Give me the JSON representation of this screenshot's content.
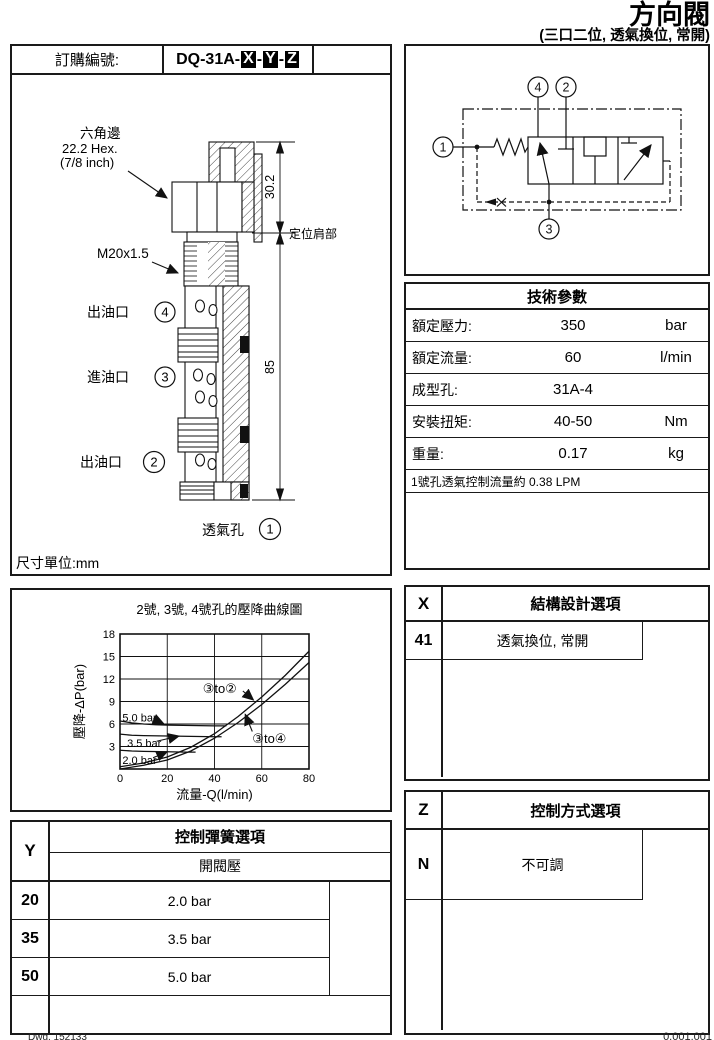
{
  "page": {
    "title": "方向閥",
    "subtitle": "(三口二位, 透氣換位, 常開)",
    "footer_left": "Dwg. 152133",
    "footer_right": "0.001.001"
  },
  "order": {
    "label": "訂購編號:",
    "prefix": "DQ-31A-",
    "dash": "-",
    "x": "X",
    "y": "Y",
    "z": "Z"
  },
  "drawing": {
    "unit_note": "尺寸單位:mm",
    "hex_label_1": "六角邊",
    "hex_label_2": "22.2 Hex.",
    "hex_label_3": "(7/8 inch)",
    "thread_label": "M20x1.5",
    "shoulder_label": "定位肩部",
    "dim_top": "30.2",
    "dim_body": "85",
    "port4_label": "出油口",
    "port3_label": "進油口",
    "port2_label": "出油口",
    "port1_label": "透氣孔",
    "port_numbers": {
      "p1": "1",
      "p2": "2",
      "p3": "3",
      "p4": "4"
    }
  },
  "schematic": {
    "p1": "1",
    "p2": "2",
    "p3": "3",
    "p4": "4"
  },
  "tech_table": {
    "title": "技術參數",
    "rows": [
      {
        "label": "額定壓力:",
        "value": "350",
        "unit": "bar"
      },
      {
        "label": "額定流量:",
        "value": "60",
        "unit": "l/min"
      },
      {
        "label": "成型孔:",
        "value": "31A-4",
        "unit": ""
      },
      {
        "label": "安裝扭矩:",
        "value": "40-50",
        "unit": "Nm"
      },
      {
        "label": "重量:",
        "value": "0.17",
        "unit": "kg"
      }
    ],
    "note": "1號孔透氣控制流量約 0.38 LPM"
  },
  "x_table": {
    "code": "X",
    "title": "結構設計選項",
    "rows": [
      {
        "code": "41",
        "desc": "透氣換位, 常開"
      }
    ]
  },
  "y_table": {
    "code": "Y",
    "title": "控制彈簧選項",
    "subtitle": "開閥壓",
    "rows": [
      {
        "code": "20",
        "desc": "2.0 bar"
      },
      {
        "code": "35",
        "desc": "3.5 bar"
      },
      {
        "code": "50",
        "desc": "5.0 bar"
      }
    ]
  },
  "z_table": {
    "code": "Z",
    "title": "控制方式選項",
    "rows": [
      {
        "code": "N",
        "desc": "不可調"
      }
    ]
  },
  "chart_data": {
    "type": "line",
    "title": "2號, 3號, 4號孔的壓降曲線圖",
    "xlabel": "流量-Q(l/min)",
    "ylabel": "壓降-ΔP(bar)",
    "xlim": [
      0,
      80
    ],
    "ylim": [
      0,
      18
    ],
    "xticks": [
      0,
      20,
      40,
      60,
      80
    ],
    "yticks": [
      3,
      6,
      9,
      12,
      15,
      18
    ],
    "grid": true,
    "legend_position": "none",
    "series": [
      {
        "name": "③to②",
        "x": [
          0,
          10,
          20,
          30,
          40,
          50,
          55,
          60,
          70,
          80
        ],
        "y": [
          0.3,
          0.8,
          1.6,
          2.9,
          4.7,
          7.0,
          8.3,
          9.6,
          12.5,
          15.7
        ]
      },
      {
        "name": "③to④",
        "x": [
          0,
          10,
          20,
          30,
          40,
          50,
          60,
          70,
          80
        ],
        "y": [
          0.0,
          0.5,
          1.2,
          2.4,
          4.1,
          6.2,
          8.6,
          11.3,
          14.2
        ]
      },
      {
        "name": "5.0 bar",
        "x": [
          0,
          5,
          10,
          15,
          20,
          30,
          40,
          45
        ],
        "y": [
          6.4,
          6.15,
          6.0,
          5.9,
          5.85,
          5.8,
          5.75,
          5.75
        ]
      },
      {
        "name": "3.5 bar",
        "x": [
          0,
          5,
          10,
          20,
          30,
          40,
          43
        ],
        "y": [
          4.65,
          4.5,
          4.45,
          4.4,
          4.35,
          4.3,
          4.3
        ]
      },
      {
        "name": "2.0 bar",
        "x": [
          0,
          5,
          10,
          20,
          28,
          32
        ],
        "y": [
          2.5,
          2.4,
          2.35,
          2.3,
          2.25,
          2.25
        ]
      }
    ],
    "annotations": [
      {
        "text": "5.0 bar",
        "tx": 1,
        "ty": 6.9,
        "sx": 14,
        "sy": 6.7,
        "ax": 18.5,
        "ay": 6.05,
        "fs": 11
      },
      {
        "text": "3.5 bar",
        "tx": 3,
        "ty": 3.5,
        "sx": 15.5,
        "sy": 3.7,
        "ax": 25,
        "ay": 4.4,
        "fs": 11
      },
      {
        "text": "2.0 bar",
        "tx": 1,
        "ty": 1.2,
        "sx": 14,
        "sy": 1.5,
        "ax": 20,
        "ay": 2.3,
        "fs": 11
      },
      {
        "text": "③to②",
        "tx": 35,
        "ty": 10.7,
        "sx": 52,
        "sy": 10.4,
        "ax": 56.5,
        "ay": 9.2,
        "fs": 13
      },
      {
        "text": "③to④",
        "tx": 56,
        "ty": 4.0,
        "sx": 56,
        "sy": 5.0,
        "ax": 53,
        "ay": 7.3,
        "fs": 13
      }
    ]
  }
}
